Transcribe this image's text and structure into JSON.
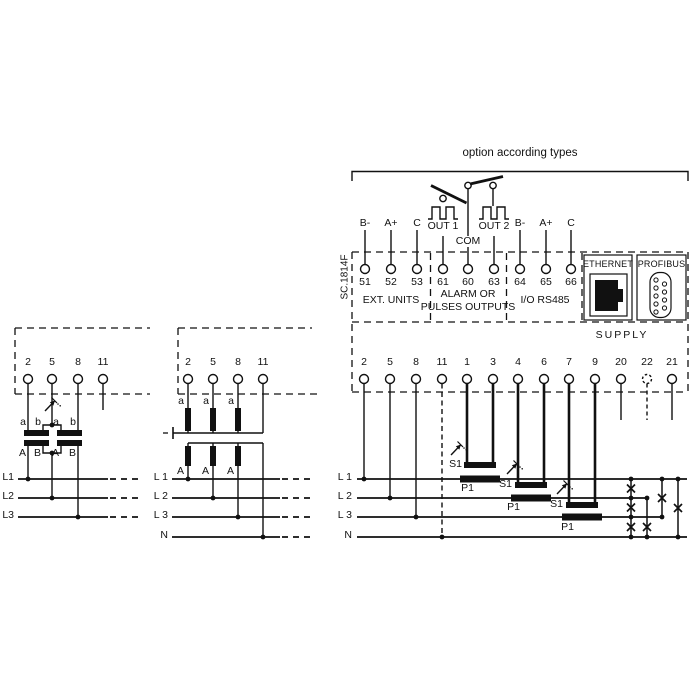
{
  "title": "option according types",
  "model": "SC.1814F",
  "io_labels": [
    "B-",
    "A+",
    "C",
    "OUT 1",
    "COM",
    "OUT 2",
    "B-",
    "A+",
    "C"
  ],
  "top_terminal_numbers": [
    "51",
    "52",
    "53",
    "61",
    "60",
    "63",
    "64",
    "65",
    "66"
  ],
  "sections": {
    "ext_units": "EXT. UNITS",
    "alarm_line1": "ALARM OR",
    "alarm_line2": "PULSES OUTPUTS",
    "rs485": "I/O RS485",
    "ethernet": "ETHERNET",
    "profibus": "PROFIBUS",
    "supply": "SUPPLY"
  },
  "bottom_terminal_numbers": [
    "2",
    "5",
    "8",
    "11",
    "1",
    "3",
    "4",
    "6",
    "7",
    "9",
    "20",
    "22",
    "21"
  ],
  "main_diagram": {
    "lines": [
      "L 1",
      "L 2",
      "L 3",
      "N"
    ],
    "ct": {
      "s": "S1",
      "p": "P1"
    }
  },
  "diagram1": {
    "terminals": [
      "2",
      "5",
      "8",
      "11"
    ],
    "secondary": [
      "a",
      "b",
      "a",
      "b"
    ],
    "primary": [
      "A",
      "B",
      "A",
      "B"
    ],
    "lines": [
      "L1",
      "L2",
      "L3"
    ]
  },
  "diagram2": {
    "terminals": [
      "2",
      "5",
      "8",
      "11"
    ],
    "secondary": [
      "a",
      "a",
      "a"
    ],
    "primary": [
      "A",
      "A",
      "A"
    ],
    "lines": [
      "L 1",
      "L 2",
      "L 3",
      "N"
    ]
  }
}
